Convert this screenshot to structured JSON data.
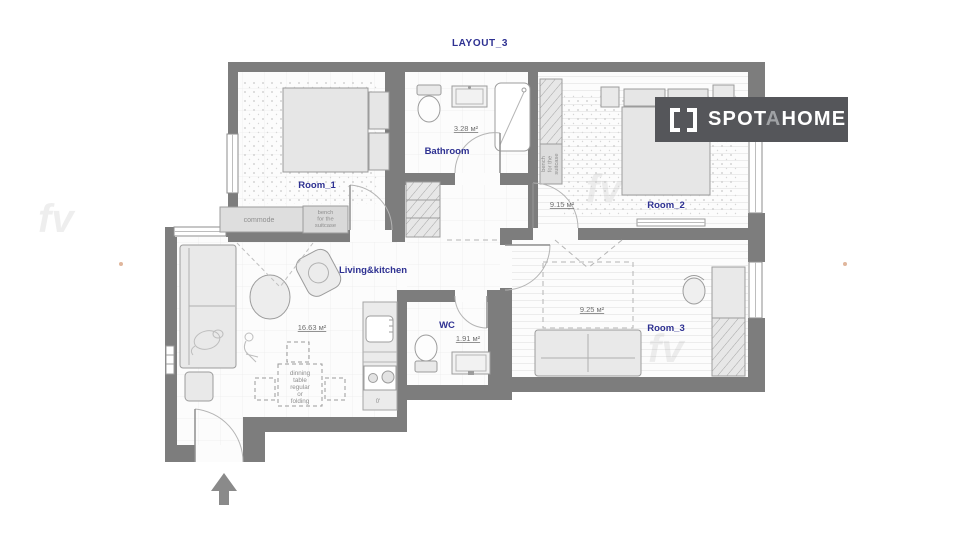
{
  "title": "LAYOUT_3",
  "logo": {
    "part1": "SPOT",
    "part2": "A",
    "part3": "HOME"
  },
  "rooms": {
    "room1": {
      "name": "Room_1"
    },
    "bathroom": {
      "name": "Bathroom",
      "area": "3.28 м²"
    },
    "room2": {
      "name": "Room_2",
      "area": "9.15 м²"
    },
    "living": {
      "name": "Living&kitchen",
      "area": "16.63 м²"
    },
    "wc": {
      "name": "WC",
      "area": "1.91 м²"
    },
    "room3": {
      "name": "Room_3",
      "area": "9.25 м²"
    }
  },
  "furniture": {
    "commode": "commode",
    "bench1_line1": "bench",
    "bench1_line2": "for the",
    "bench1_line3": "suitcase",
    "bench2_line1": "bench",
    "bench2_line2": "for the",
    "bench2_line3": "suitcase",
    "dining_line1": "dinning",
    "dining_line2": "table",
    "dining_line3": "regular",
    "dining_line4": "or",
    "dining_line5": "folding",
    "kitchen_note": "0'"
  },
  "watermark": "fv",
  "colors": {
    "wall": "#7d7d7d",
    "accent": "#2e3192",
    "furniture_fill": "#e9e9e9",
    "logo_bg": "#55565a"
  }
}
